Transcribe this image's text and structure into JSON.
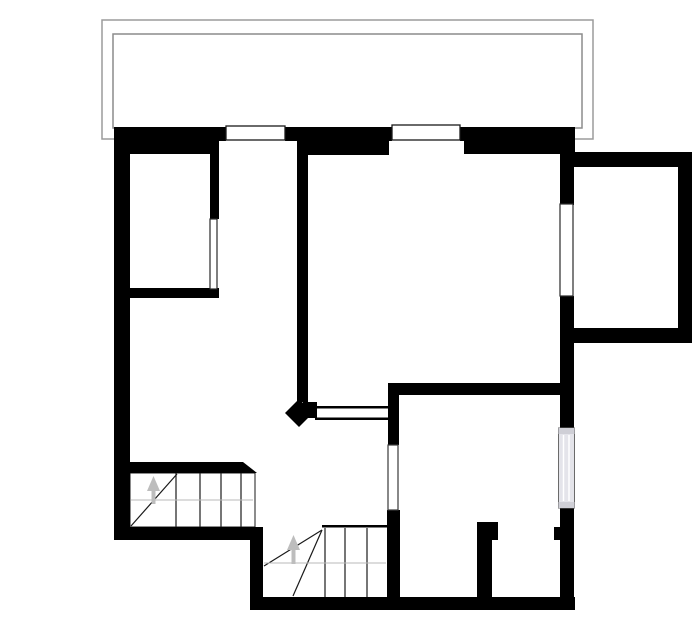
{
  "meta": {
    "type": "architectural-floor-plan",
    "canvas": {
      "width": 700,
      "height": 644,
      "background": "#ffffff"
    }
  },
  "colors": {
    "wall": "#000000",
    "balcony_outline": "#9b9b9b",
    "balcony_outline_inner": "#8c8c8c",
    "stair_line": "#1a1a1a",
    "walk_line": "#b8b8b8",
    "arrow": "#bdbdbd",
    "window_fill": "#ffffff",
    "window_frame": "#1a1a1a",
    "glazing_fill": "#e4e4ea",
    "glazing_frame": "#6a6a6a",
    "glazing_cap": "#cfcfd6"
  },
  "layers": [
    {
      "name": "balcony",
      "shapes": [
        {
          "name": "balcony-outer-edge",
          "kind": "rect",
          "x": 102,
          "y": 20,
          "w": 491,
          "h": 119,
          "fill": "none",
          "stroke": "#9b9b9b",
          "sw": 1.5
        },
        {
          "name": "balcony-inner-edge",
          "kind": "rect",
          "x": 113,
          "y": 34,
          "w": 469,
          "h": 94,
          "fill": "none",
          "stroke": "#8c8c8c",
          "sw": 1.5
        }
      ]
    },
    {
      "name": "stair-surfaces",
      "shapes": [
        {
          "name": "stair1-floor",
          "kind": "rect",
          "x": 130,
          "y": 473,
          "w": 125,
          "h": 54,
          "fill": "#ffffff",
          "stroke": "#1a1a1a",
          "sw": 1
        }
      ]
    },
    {
      "name": "walls",
      "shapes": [
        {
          "name": "top-wall-left",
          "kind": "rect",
          "x": 114,
          "y": 127,
          "w": 112,
          "h": 14
        },
        {
          "name": "top-wall-mid",
          "kind": "rect",
          "x": 285,
          "y": 127,
          "w": 107,
          "h": 14
        },
        {
          "name": "top-wall-right",
          "kind": "rect",
          "x": 460,
          "y": 127,
          "w": 115,
          "h": 14
        },
        {
          "name": "top-wall-left-inner",
          "kind": "rect",
          "x": 114,
          "y": 140,
          "w": 105,
          "h": 14
        },
        {
          "name": "top-wall-mid-inner",
          "kind": "rect",
          "x": 297,
          "y": 140,
          "w": 92,
          "h": 15
        },
        {
          "name": "top-wall-right-inner",
          "kind": "rect",
          "x": 464,
          "y": 140,
          "w": 111,
          "h": 14
        },
        {
          "name": "left-wall",
          "kind": "rect",
          "x": 114,
          "y": 128,
          "w": 16,
          "h": 412
        },
        {
          "name": "bottom-left-wall",
          "kind": "rect",
          "x": 114,
          "y": 527,
          "w": 149,
          "h": 13
        },
        {
          "name": "lower-left-wall",
          "kind": "rect",
          "x": 250,
          "y": 537,
          "w": 13,
          "h": 73
        },
        {
          "name": "bottom-wall",
          "kind": "rect",
          "x": 250,
          "y": 597,
          "w": 325,
          "h": 13
        },
        {
          "name": "right-wall-upper",
          "kind": "rect",
          "x": 560,
          "y": 153,
          "w": 14,
          "h": 52
        },
        {
          "name": "right-wall-mid",
          "kind": "rect",
          "x": 560,
          "y": 296,
          "w": 14,
          "h": 132
        },
        {
          "name": "right-wall-lower",
          "kind": "rect",
          "x": 560,
          "y": 508,
          "w": 14,
          "h": 102
        },
        {
          "name": "annex-top-wall",
          "kind": "rect",
          "x": 560,
          "y": 152,
          "w": 132,
          "h": 15
        },
        {
          "name": "annex-right-wall",
          "kind": "rect",
          "x": 678,
          "y": 152,
          "w": 14,
          "h": 191
        },
        {
          "name": "annex-bottom-wall",
          "kind": "rect",
          "x": 573,
          "y": 328,
          "w": 119,
          "h": 15
        },
        {
          "name": "closet-right-wall",
          "kind": "rect",
          "x": 210,
          "y": 140,
          "w": 9,
          "h": 79
        },
        {
          "name": "closet-bottom-wall",
          "kind": "rect",
          "x": 130,
          "y": 288,
          "w": 89,
          "h": 10
        },
        {
          "name": "hall-center-wall",
          "kind": "rect",
          "x": 297,
          "y": 140,
          "w": 11,
          "h": 262
        },
        {
          "name": "hall-wall-end-diamond",
          "kind": "poly",
          "points": "285,413 299,399 313,413 299,427"
        },
        {
          "name": "hall-wall-end-stub",
          "kind": "rect",
          "x": 303,
          "y": 402,
          "w": 14,
          "h": 16
        },
        {
          "name": "passage-top-jamb-line",
          "kind": "rect",
          "x": 315,
          "y": 406,
          "w": 74,
          "h": 2.5
        },
        {
          "name": "passage-bottom-jamb-line",
          "kind": "rect",
          "x": 315,
          "y": 417.5,
          "w": 74,
          "h": 2.5
        },
        {
          "name": "bedroom-left-wall",
          "kind": "rect",
          "x": 388,
          "y": 383,
          "w": 11,
          "h": 62
        },
        {
          "name": "bedroom-top-wall",
          "kind": "rect",
          "x": 388,
          "y": 383,
          "w": 174,
          "h": 12
        },
        {
          "name": "stair2-right-wall",
          "kind": "rect",
          "x": 387,
          "y": 510,
          "w": 13,
          "h": 100
        },
        {
          "name": "compartment-left-wall",
          "kind": "rect",
          "x": 477,
          "y": 522,
          "w": 15,
          "h": 88
        },
        {
          "name": "compartment-top-stub",
          "kind": "rect",
          "x": 492,
          "y": 522,
          "w": 6,
          "h": 18
        },
        {
          "name": "compartment-right-jamb",
          "kind": "rect",
          "x": 554,
          "y": 527,
          "w": 7,
          "h": 13
        },
        {
          "name": "stair1-top-wall",
          "kind": "rect",
          "x": 130,
          "y": 462,
          "w": 113,
          "h": 11
        },
        {
          "name": "stair1-top-wall-end",
          "kind": "poly",
          "points": "243,462 257,473 243,473"
        },
        {
          "name": "stair2-edge-line",
          "kind": "rect",
          "x": 322,
          "y": 525,
          "w": 65,
          "h": 2.5
        }
      ]
    },
    {
      "name": "stairs",
      "shapes": [
        {
          "name": "stair1-tread-1",
          "kind": "line",
          "x1": 176,
          "y1": 473,
          "x2": 176,
          "y2": 527
        },
        {
          "name": "stair1-tread-2",
          "kind": "line",
          "x1": 200,
          "y1": 473,
          "x2": 200,
          "y2": 527
        },
        {
          "name": "stair1-tread-3",
          "kind": "line",
          "x1": 221,
          "y1": 473,
          "x2": 221,
          "y2": 527
        },
        {
          "name": "stair1-tread-4",
          "kind": "line",
          "x1": 241,
          "y1": 473,
          "x2": 241,
          "y2": 527
        },
        {
          "name": "stair1-winder-line",
          "kind": "line",
          "x1": 131,
          "y1": 526,
          "x2": 177,
          "y2": 474
        },
        {
          "name": "stair1-walk-line",
          "kind": "line",
          "x1": 131,
          "y1": 500,
          "x2": 253,
          "y2": 500,
          "stroke": "#b8b8b8",
          "sw": 1
        },
        {
          "name": "stair1-up-arrow-head",
          "kind": "poly",
          "points": "147,491 160,491 153.5,476",
          "fill": "#bdbdbd"
        },
        {
          "name": "stair1-up-arrow-shaft",
          "kind": "rect",
          "x": 151.5,
          "y": 491,
          "w": 4,
          "h": 13,
          "fill": "#bdbdbd"
        },
        {
          "name": "stair2-tread-1",
          "kind": "line",
          "x1": 325,
          "y1": 528,
          "x2": 325,
          "y2": 597
        },
        {
          "name": "stair2-tread-2",
          "kind": "line",
          "x1": 345,
          "y1": 528,
          "x2": 345,
          "y2": 597
        },
        {
          "name": "stair2-tread-3",
          "kind": "line",
          "x1": 367,
          "y1": 528,
          "x2": 367,
          "y2": 597
        },
        {
          "name": "stair2-winder-line-1",
          "kind": "line",
          "x1": 322,
          "y1": 530,
          "x2": 264,
          "y2": 566
        },
        {
          "name": "stair2-winder-line-2",
          "kind": "line",
          "x1": 322,
          "y1": 530,
          "x2": 293,
          "y2": 596
        },
        {
          "name": "stair2-walk-line",
          "kind": "line",
          "x1": 264,
          "y1": 563,
          "x2": 386,
          "y2": 563,
          "stroke": "#b8b8b8",
          "sw": 1
        },
        {
          "name": "stair2-up-arrow-head",
          "kind": "poly",
          "points": "287,550 300,550 293.5,535",
          "fill": "#bdbdbd"
        },
        {
          "name": "stair2-up-arrow-shaft",
          "kind": "rect",
          "x": 291.5,
          "y": 550,
          "w": 4,
          "h": 14,
          "fill": "#bdbdbd"
        }
      ]
    },
    {
      "name": "openings",
      "shapes": [
        {
          "name": "window-top-left",
          "kind": "rect",
          "x": 226,
          "y": 126,
          "w": 59,
          "h": 14,
          "fill": "#ffffff",
          "stroke": "#1a1a1a",
          "sw": 1.3
        },
        {
          "name": "window-top-center",
          "kind": "rect",
          "x": 392,
          "y": 125,
          "w": 68,
          "h": 15,
          "fill": "#ffffff",
          "stroke": "#1a1a1a",
          "sw": 1.3
        },
        {
          "name": "window-right-upper",
          "kind": "rect",
          "x": 560,
          "y": 204,
          "w": 13,
          "h": 92,
          "fill": "#ffffff",
          "stroke": "#2a2a2a",
          "sw": 1.2
        },
        {
          "name": "closet-partition",
          "kind": "rect",
          "x": 210,
          "y": 219,
          "w": 7,
          "h": 70,
          "fill": "#ffffff",
          "stroke": "#2a2a2a",
          "sw": 1.2
        },
        {
          "name": "doorway-opening-lower",
          "kind": "rect",
          "x": 388,
          "y": 445,
          "w": 10,
          "h": 65,
          "fill": "#ffffff",
          "stroke": "#3a3a3a",
          "sw": 1.2
        },
        {
          "name": "window-right-lower-glazing",
          "kind": "rect",
          "x": 558.5,
          "y": 428,
          "w": 16,
          "h": 80,
          "fill": "#e4e4ea",
          "stroke": "#6a6a6a",
          "sw": 1
        },
        {
          "name": "window-right-lower-cap-top",
          "kind": "rect",
          "x": 558.5,
          "y": 428,
          "w": 16,
          "h": 6,
          "fill": "#cfcfd6"
        },
        {
          "name": "window-right-lower-cap-bottom",
          "kind": "rect",
          "x": 558.5,
          "y": 502,
          "w": 16,
          "h": 6,
          "fill": "#cfcfd6"
        },
        {
          "name": "window-right-lower-stripe-1",
          "kind": "line",
          "x1": 563.5,
          "y1": 435,
          "x2": 563.5,
          "y2": 501,
          "stroke": "#ffffff",
          "sw": 1.5
        },
        {
          "name": "window-right-lower-stripe-2",
          "kind": "line",
          "x1": 569,
          "y1": 435,
          "x2": 569,
          "y2": 501,
          "stroke": "#ffffff",
          "sw": 1.5
        }
      ]
    }
  ]
}
